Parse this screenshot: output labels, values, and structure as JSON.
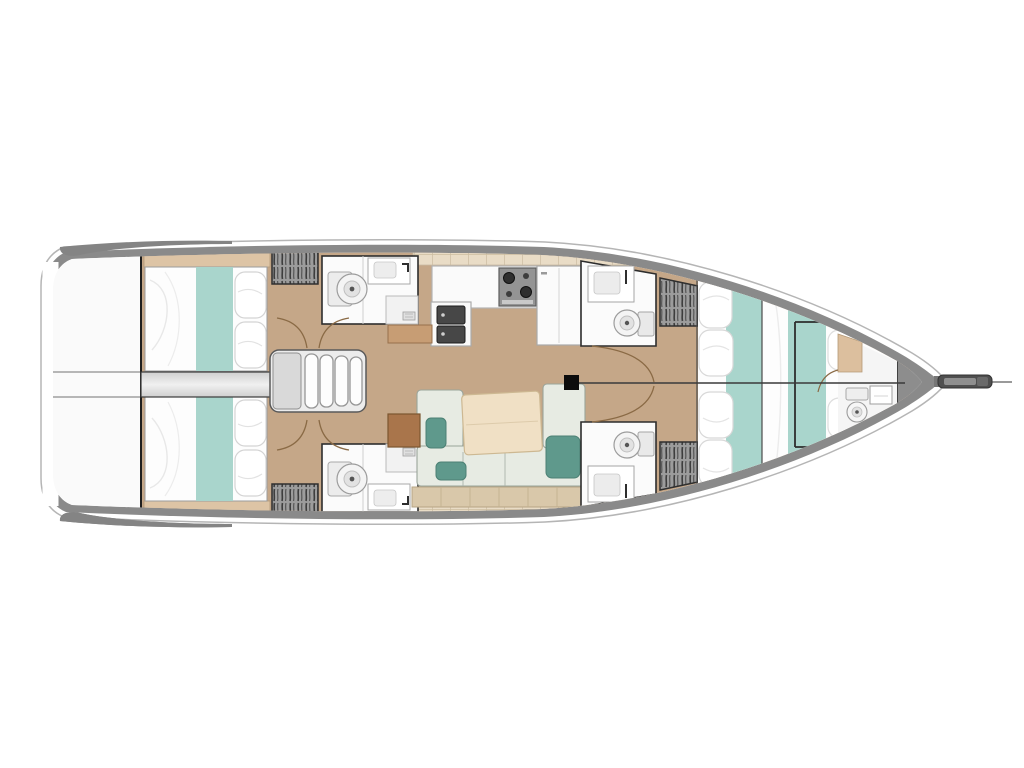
{
  "title": "Sailing yacht interior layout plan (top-down deck plan, bow to the right)",
  "diagram_type": "yacht-floor-plan",
  "orientation": {
    "bow": "right",
    "stern": "left",
    "port": "top",
    "starboard": "bottom"
  },
  "rooms": {
    "stern_platform": {
      "label": "Stern swim platform / transom"
    },
    "aft_cabin_port": {
      "label": "Aft double cabin (port) with berth and pillows"
    },
    "aft_cabin_starboard": {
      "label": "Aft double cabin (starboard) with berth and pillows"
    },
    "aft_head_port": {
      "label": "Aft bathroom (port) with toilet, sink and shower"
    },
    "aft_head_starboard": {
      "label": "Aft bathroom (starboard) with toilet, sink and shower"
    },
    "wardrobe_aft_port": {
      "label": "Hanging locker (aft port)"
    },
    "wardrobe_aft_starboard": {
      "label": "Hanging locker (aft starboard)"
    },
    "companionway": {
      "label": "Companionway entry steps"
    },
    "galley": {
      "label": "Galley with double sink, stove and refrigerator"
    },
    "salon": {
      "label": "Salon with sofa, accent cushions and dining table"
    },
    "nav_seat": {
      "label": "Chart / navigation seat"
    },
    "fore_head_port": {
      "label": "Forward bathroom (port) with toilet and sink"
    },
    "fore_head_starboard": {
      "label": "Forward bathroom (starboard) with toilet and sink"
    },
    "wardrobe_fore_port": {
      "label": "Hanging locker (forward port)"
    },
    "wardrobe_fore_starboard": {
      "label": "Hanging locker (forward starboard)"
    },
    "forward_cabin": {
      "label": "Forward owner cabin with large double berth"
    },
    "bow_head": {
      "label": "Bow bathroom with toilet and washbasin"
    },
    "mast": {
      "label": "Mast base"
    },
    "bowsprit": {
      "label": "Bow anchor fitting / bowsprit"
    },
    "engine_corridor": {
      "label": "Central passage / engine space between aft cabins"
    }
  },
  "colors": {
    "hull_rim": "#8a8a8a",
    "hull_stroke": "#b5b5b5",
    "interior": "#ffffff",
    "floor": "#c5a788",
    "shelf": "#ddc4a5",
    "cell_strip": "#e9dcc6",
    "bed_white": "#fdfdfd",
    "aqua": "#a9d5cc",
    "sofa": "#e7ebe3",
    "teal_cushion": "#5f998c",
    "table": "#f0e0c5",
    "seatback": "#d9c8aa",
    "nav_wood": "#a9754b",
    "cabinet_tan": "#c79d74",
    "corridor": "#e4e4e4",
    "fixture": "#f7f7f7",
    "stove": "#949494",
    "outline": "#2d2d2d",
    "door": "#8a6a45"
  }
}
